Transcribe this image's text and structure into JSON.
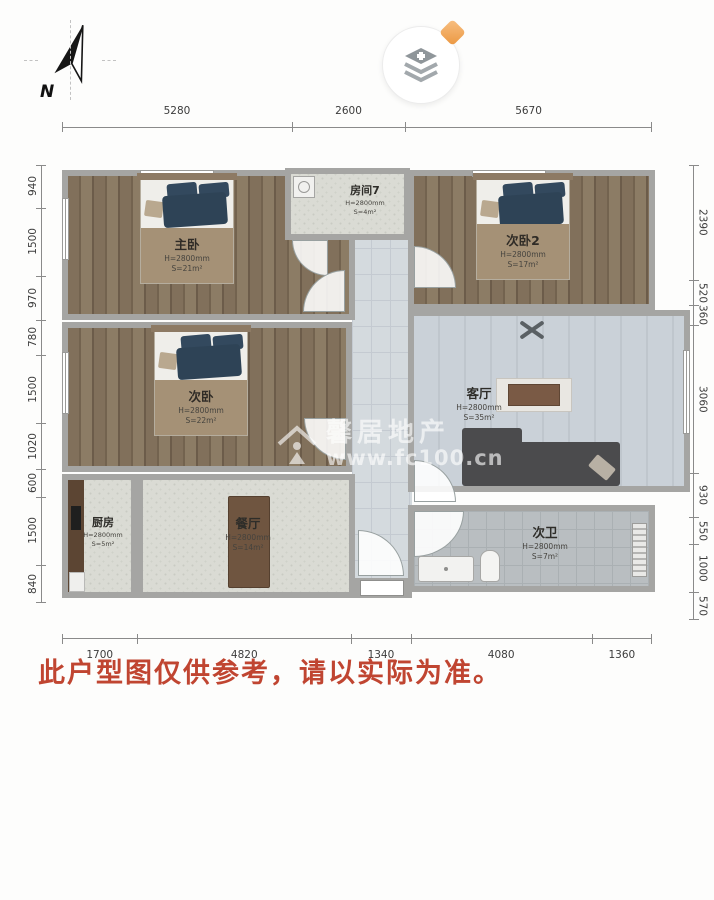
{
  "compass": {
    "label": "N"
  },
  "icons": {
    "compass": "compass-north-arrow-icon",
    "map_control": "layers-plus-icon",
    "badge": "gem-badge-icon",
    "watermark_logo": "house-logo-icon"
  },
  "dimensions": {
    "top": [
      "5280",
      "2600",
      "5670"
    ],
    "bottom": [
      "1700",
      "4820",
      "1340",
      "4080",
      "1360"
    ],
    "left": [
      "940",
      "1500",
      "970",
      "780",
      "1500",
      "1020",
      "600",
      "1500",
      "840"
    ],
    "right": [
      "2390",
      "520",
      "360",
      "3060",
      "930",
      "550",
      "1000",
      "570"
    ]
  },
  "rooms": [
    {
      "name": "主卧",
      "height": "H=2800mm",
      "area": "S=21m²"
    },
    {
      "name": "房间7",
      "height": "H=2800mm",
      "area": "S=4m²"
    },
    {
      "name": "次卧2",
      "height": "H=2800mm",
      "area": "S=17m²"
    },
    {
      "name": "次卧",
      "height": "H=2800mm",
      "area": "S=22m²"
    },
    {
      "name": "客厅",
      "height": "H=2800mm",
      "area": "S=35m²"
    },
    {
      "name": "厨房",
      "height": "H=2800mm",
      "area": "S=5m²"
    },
    {
      "name": "餐厅",
      "height": "H=2800mm",
      "area": "S=14m²"
    },
    {
      "name": "次卫",
      "height": "H=2800mm",
      "area": "S=7m²"
    }
  ],
  "watermark": {
    "brand": "馨居地产",
    "site": "www.fc100.cn"
  },
  "disclaimer": {
    "text": "此户型图仅供参考，请以实际为准。",
    "color": "#c04531"
  },
  "colors": {
    "wall": "#a5a5a3",
    "wood_floor": "#81705b",
    "living_floor": "#c8cfd6",
    "bed_blanket": "#2e4356",
    "label_box": "#a59176",
    "badge_orange": "#eb9740"
  }
}
